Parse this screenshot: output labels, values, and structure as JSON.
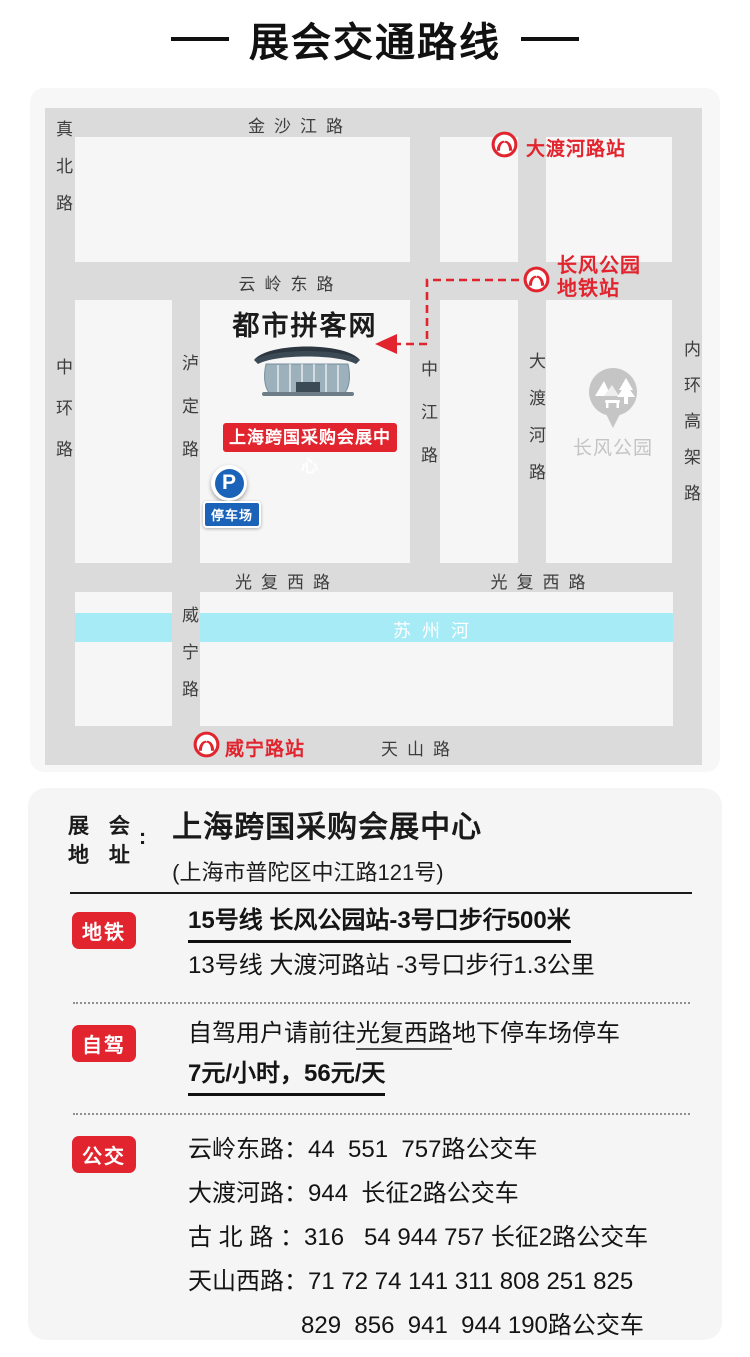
{
  "title": "展会交通路线",
  "colors": {
    "accent_red": "#e2242e",
    "parking_blue": "#1b63b8",
    "river_blue": "#a7ebf7",
    "road_gray": "#dbdbdb",
    "block_gray": "#f6f6f6"
  },
  "map": {
    "roads": {
      "jinshajiang": "金沙江路",
      "zhenbei": "真北路",
      "yunling_east": "云岭东路",
      "zhonghuan": "中环路",
      "luding": "泸定路",
      "zhongjiang": "中江路",
      "daduhe": "大渡河路",
      "neihuan_elevated": "内环高架路",
      "guangfu_west_left": "光复西路",
      "guangfu_west_right": "光复西路",
      "weining": "威宁路",
      "tianshan": "天山路"
    },
    "river": "苏州河",
    "stations": {
      "daduhe": "大渡河路站",
      "changfeng_line1": "长风公园",
      "changfeng_line2": "地铁站",
      "weining": "威宁路站"
    },
    "venue": {
      "watermark": "都市拼客网",
      "badge": "上海跨国采购会展中心",
      "parking_p": "P",
      "parking_label": "停车场"
    },
    "park_label": "长风公园"
  },
  "address": {
    "label_line1": "展 会",
    "label_line2": "地 址",
    "colon": ":",
    "name": "上海跨国采购会展中心",
    "detail": "(上海市普陀区中江路121号)"
  },
  "sections": {
    "metro": {
      "badge": "地铁",
      "line1": "15号线 长风公园站-3号口步行500米",
      "line2": "13号线 大渡河路站 -3号口步行1.3公里"
    },
    "drive": {
      "badge": "自驾",
      "line1_pre": "自驾用户请前往",
      "line1_underline": "光复西路",
      "line1_post": "地下停车场停车",
      "line2": "7元/小时，56元/天"
    },
    "bus": {
      "badge": "公交",
      "lines": [
        "云岭东路：44  551  757路公交车",
        "大渡河路：944  长征2路公交车",
        "古 北 路 ：316   54 944 757 长征2路公交车",
        "天山西路：71 72 74 141 311 808 251 825",
        "829  856  941  944 190路公交车"
      ]
    }
  }
}
